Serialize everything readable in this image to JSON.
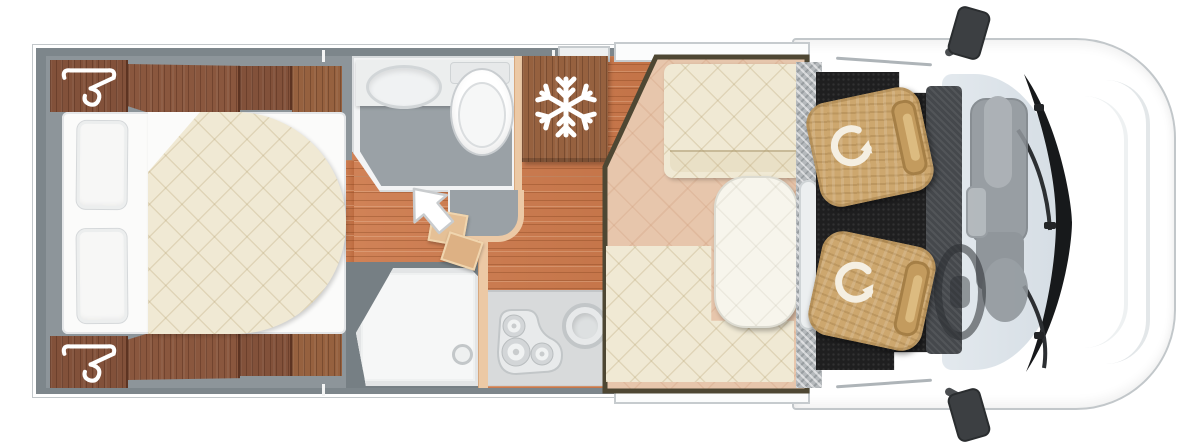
{
  "image": {
    "type": "motorhome floor plan, top-down view",
    "width_px": 1200,
    "height_px": 444,
    "visible_text": "none — pictorial diagram only"
  },
  "rooms": [
    {
      "name": "bedroom",
      "label": "Rear bedroom",
      "features": [
        "double bed with quilted duvet rounded on walkway side",
        "white fitted sheet",
        "two pillows",
        "wardrobe with clothes-hanger symbol (top corner)",
        "wardrobe with clothes-hanger symbol (bottom corner)",
        "overhead wood cabinet rows along both walls"
      ]
    },
    {
      "name": "bathroom",
      "label": "Washroom",
      "features": [
        "counter with oval washbasin",
        "toilet with cistern",
        "grey floor",
        "angled entry corner"
      ]
    },
    {
      "name": "fridge",
      "label": "Refrigerator cabinet",
      "features": [
        "wood-front cabinet marked with white snowflake symbol"
      ]
    },
    {
      "name": "shower",
      "label": "Shower cubicle",
      "features": [
        "white shower tray with angled corner",
        "drain cap"
      ]
    },
    {
      "name": "kitchen",
      "label": "Kitchen block",
      "features": [
        "three-burner gas hob",
        "round sink",
        "grey worktop",
        "partition wall"
      ]
    },
    {
      "name": "entrance",
      "label": "Habitation door area",
      "features": [
        "white arrow pointing into the vehicle",
        "two entry steps",
        "wood-plank floor"
      ]
    },
    {
      "name": "dinette",
      "label": "Dinette lounge",
      "features": [
        "straight bench seat at front wall",
        "L-shaped bench seat",
        "oval pedestal table",
        "beige carpet with diamond pattern",
        "dark trim outline"
      ]
    },
    {
      "name": "cab",
      "label": "Driver cab",
      "features": [
        "driver swivel seat with rotation arrow",
        "passenger swivel seat with rotation arrow",
        "black cab carpet",
        "dashboard",
        "engine/console hump",
        "steering wheel",
        "windscreen with two wipers",
        "two exterior side mirrors",
        "entry step strip with tread pattern"
      ]
    }
  ],
  "icons": [
    {
      "name": "hanger-icon",
      "meaning": "wardrobe / clothes storage",
      "count": 2,
      "color": "#ffffff"
    },
    {
      "name": "snowflake-icon",
      "meaning": "refrigerator / freezer",
      "count": 1,
      "color": "#ffffff"
    },
    {
      "name": "entry-arrow-icon",
      "meaning": "entrance direction",
      "count": 1,
      "color": "#ffffff"
    },
    {
      "name": "swivel-arrow-icon",
      "meaning": "rotating cab seat",
      "count": 2,
      "color": "#ffffff"
    }
  ],
  "colors": {
    "background": "#ffffff",
    "wall_grey": "#7d868b",
    "bedroom_floor": "#8d959a",
    "wood_cabinet": "#82513a",
    "wood_floor": "#c8794c",
    "quilt_cream": "#f0e9d4",
    "dinette_carpet": "#e7c6ac",
    "dinette_trim": "#4e4733",
    "partition_peach": "#ecc9a5",
    "counter_grey": "#d8dadb",
    "cab_carpet_black": "#1f1f20",
    "seat_tan": "#cda76e",
    "windshield_blue": "#dde4ea"
  }
}
